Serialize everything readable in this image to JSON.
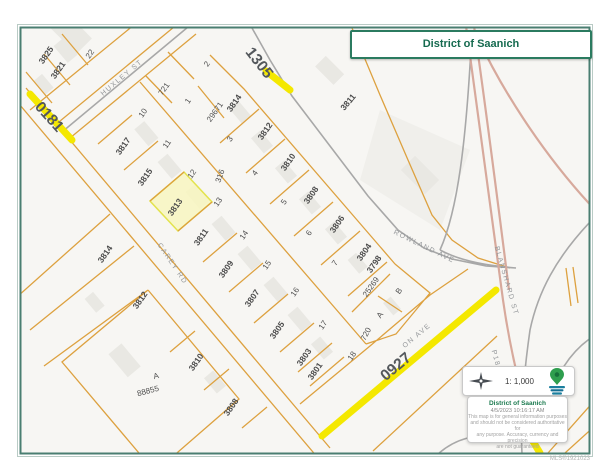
{
  "title_box": {
    "title": "District of Saanich"
  },
  "legend": {
    "scale": "1: 1,000",
    "org": "District of Saanich",
    "date": "4/5/2023 10:16:17 AM",
    "disclaimer_lines": [
      "This map is for general information purposes",
      "and should not be considered authoritative for",
      "any purpose. Accuracy, currency and precision",
      "are not guaranteed"
    ],
    "compass_icon": "north-arrow",
    "logo_icon": "saanich-map-pin"
  },
  "watermark": "MLS®1921023",
  "colors": {
    "frame": "#4a7e71",
    "title_green": "#156a4f",
    "parcel_line": "#dda13f",
    "highlight_route": "#f4e800",
    "selected_parcel_fill": "#f8f6c0",
    "selected_parcel_stroke": "#e3e34d",
    "highway_pink": "#d7a99c",
    "road_gray": "#a8a8a8",
    "logo_green": "#2f9e4e",
    "logo_teal": "#1b7f9e"
  },
  "map": {
    "selected_parcel": {
      "address": "3813",
      "lot": "12"
    },
    "labels": [
      {
        "name": "parcel-label-3825",
        "text": "3825",
        "x": 46,
        "y": 55,
        "r": -55,
        "cls": "addr"
      },
      {
        "name": "parcel-label-3821",
        "text": "3821",
        "x": 58,
        "y": 70,
        "r": -55,
        "cls": "addr"
      },
      {
        "name": "parcel-label-3817",
        "text": "3817",
        "x": 123,
        "y": 146,
        "r": -55,
        "cls": "addr"
      },
      {
        "name": "parcel-label-3815",
        "text": "3815",
        "x": 145,
        "y": 177,
        "r": -55,
        "cls": "addr"
      },
      {
        "name": "parcel-label-3813",
        "text": "3813",
        "x": 175,
        "y": 207,
        "r": -55,
        "cls": "addr"
      },
      {
        "name": "parcel-label-3811",
        "text": "3811",
        "x": 201,
        "y": 237,
        "r": -55,
        "cls": "addr"
      },
      {
        "name": "parcel-label-3809",
        "text": "3809",
        "x": 226,
        "y": 269,
        "r": -55,
        "cls": "addr"
      },
      {
        "name": "parcel-label-3807",
        "text": "3807",
        "x": 252,
        "y": 298,
        "r": -55,
        "cls": "addr"
      },
      {
        "name": "parcel-label-3805",
        "text": "3805",
        "x": 277,
        "y": 330,
        "r": -55,
        "cls": "addr"
      },
      {
        "name": "parcel-label-3803",
        "text": "3803",
        "x": 304,
        "y": 357,
        "r": -55,
        "cls": "addr"
      },
      {
        "name": "parcel-label-3801",
        "text": "3801",
        "x": 315,
        "y": 371,
        "r": -55,
        "cls": "addr"
      },
      {
        "name": "parcel-label-29671",
        "text": "29671",
        "x": 215,
        "y": 112,
        "r": -55,
        "cls": "lot"
      },
      {
        "name": "parcel-label-3814-upper",
        "text": "3814",
        "x": 234,
        "y": 103,
        "r": -55,
        "cls": "addr"
      },
      {
        "name": "parcel-label-3812-upper",
        "text": "3812",
        "x": 265,
        "y": 131,
        "r": -55,
        "cls": "addr"
      },
      {
        "name": "parcel-label-3810-upper",
        "text": "3810",
        "x": 288,
        "y": 162,
        "r": -55,
        "cls": "addr"
      },
      {
        "name": "parcel-label-3808-upper",
        "text": "3808",
        "x": 311,
        "y": 195,
        "r": -55,
        "cls": "addr"
      },
      {
        "name": "parcel-label-3806",
        "text": "3806",
        "x": 337,
        "y": 224,
        "r": -55,
        "cls": "addr"
      },
      {
        "name": "parcel-label-3804",
        "text": "3804",
        "x": 364,
        "y": 252,
        "r": -55,
        "cls": "addr"
      },
      {
        "name": "parcel-label-3798",
        "text": "3798",
        "x": 374,
        "y": 264,
        "r": -55,
        "cls": "addr"
      },
      {
        "name": "parcel-label-25269",
        "text": "25269",
        "x": 371,
        "y": 287,
        "r": -55,
        "cls": "lot"
      },
      {
        "name": "parcel-label-720",
        "text": "720",
        "x": 366,
        "y": 334,
        "r": -62,
        "cls": "lot"
      },
      {
        "name": "parcel-label-3814-sw",
        "text": "3814",
        "x": 105,
        "y": 254,
        "r": -55,
        "cls": "addr"
      },
      {
        "name": "parcel-label-3812-sw",
        "text": "3812",
        "x": 140,
        "y": 300,
        "r": -55,
        "cls": "addr"
      },
      {
        "name": "parcel-label-3810-sw",
        "text": "3810",
        "x": 196,
        "y": 362,
        "r": -55,
        "cls": "addr"
      },
      {
        "name": "parcel-label-3808-sw",
        "text": "3808",
        "x": 231,
        "y": 407,
        "r": -55,
        "cls": "addr"
      },
      {
        "name": "parcel-label-3811-east",
        "text": "3811",
        "x": 348,
        "y": 102,
        "r": -50,
        "cls": "addr"
      },
      {
        "name": "plan-label-88855",
        "text": "88855",
        "x": 148,
        "y": 391,
        "r": -15,
        "cls": "lot"
      },
      {
        "name": "lot-label-a-sw",
        "text": "A",
        "x": 156,
        "y": 376,
        "r": -15,
        "cls": "lot"
      },
      {
        "name": "lot-label-22",
        "text": "22",
        "x": 90,
        "y": 54,
        "r": -55,
        "cls": "lot"
      },
      {
        "name": "lot-label-721",
        "text": "721",
        "x": 164,
        "y": 89,
        "r": -55,
        "cls": "lot"
      },
      {
        "name": "lot-label-10",
        "text": "10",
        "x": 143,
        "y": 113,
        "r": -55,
        "cls": "lot"
      },
      {
        "name": "lot-label-11",
        "text": "11",
        "x": 167,
        "y": 144,
        "r": -55,
        "cls": "lot"
      },
      {
        "name": "lot-label-12",
        "text": "12",
        "x": 192,
        "y": 174,
        "r": -55,
        "cls": "lot"
      },
      {
        "name": "lot-label-13",
        "text": "13",
        "x": 218,
        "y": 202,
        "r": -55,
        "cls": "lot"
      },
      {
        "name": "lot-label-14",
        "text": "14",
        "x": 244,
        "y": 235,
        "r": -55,
        "cls": "lot"
      },
      {
        "name": "lot-label-15",
        "text": "15",
        "x": 267,
        "y": 265,
        "r": -55,
        "cls": "lot"
      },
      {
        "name": "lot-label-16",
        "text": "16",
        "x": 295,
        "y": 292,
        "r": -55,
        "cls": "lot"
      },
      {
        "name": "lot-label-17",
        "text": "17",
        "x": 323,
        "y": 325,
        "r": -55,
        "cls": "lot"
      },
      {
        "name": "lot-label-18",
        "text": "18",
        "x": 352,
        "y": 356,
        "r": -55,
        "cls": "lot"
      },
      {
        "name": "lot-label-1",
        "text": "1",
        "x": 188,
        "y": 101,
        "r": -55,
        "cls": "lot"
      },
      {
        "name": "lot-label-2",
        "text": "2",
        "x": 207,
        "y": 64,
        "r": -55,
        "cls": "lot"
      },
      {
        "name": "lot-label-3",
        "text": "3",
        "x": 230,
        "y": 139,
        "r": -55,
        "cls": "lot"
      },
      {
        "name": "lot-label-4",
        "text": "4",
        "x": 255,
        "y": 173,
        "r": -55,
        "cls": "lot"
      },
      {
        "name": "lot-label-5",
        "text": "5",
        "x": 284,
        "y": 202,
        "r": -55,
        "cls": "lot"
      },
      {
        "name": "lot-label-6",
        "text": "6",
        "x": 309,
        "y": 233,
        "r": -55,
        "cls": "lot"
      },
      {
        "name": "lot-label-7",
        "text": "7",
        "x": 335,
        "y": 263,
        "r": -55,
        "cls": "lot"
      },
      {
        "name": "lot-label-b",
        "text": "B",
        "x": 399,
        "y": 291,
        "r": -55,
        "cls": "lot"
      },
      {
        "name": "lot-label-a",
        "text": "A",
        "x": 380,
        "y": 315,
        "r": -55,
        "cls": "lot"
      },
      {
        "name": "plan-label-316",
        "text": "316",
        "x": 220,
        "y": 176,
        "r": -70,
        "cls": "lot"
      },
      {
        "name": "street-label-huxley-st",
        "text": "HUXLEY ST",
        "x": 122,
        "y": 78,
        "r": -40,
        "cls": "street"
      },
      {
        "name": "street-label-carey-rd",
        "text": "CAREY RD",
        "x": 172,
        "y": 264,
        "r": 56,
        "cls": "street"
      },
      {
        "name": "street-label-rowland-ave",
        "text": "ROWLAND AVE",
        "x": 424,
        "y": 247,
        "r": 26,
        "cls": "street"
      },
      {
        "name": "street-label-blanshard-st",
        "text": "BLANSHARD ST",
        "x": 506,
        "y": 281,
        "r": 74,
        "cls": "street"
      },
      {
        "name": "street-label-vernon-ave",
        "text": "ON AVE",
        "x": 417,
        "y": 336,
        "r": -40,
        "cls": "street"
      },
      {
        "name": "street-label-p185",
        "text": "P185",
        "x": 496,
        "y": 361,
        "r": 75,
        "cls": "street"
      },
      {
        "name": "route-label-0181",
        "text": "0181",
        "x": 49,
        "y": 117,
        "r": 48,
        "cls": "route"
      },
      {
        "name": "route-label-1305",
        "text": "1305",
        "x": 259,
        "y": 63,
        "r": 52,
        "cls": "route"
      },
      {
        "name": "route-label-0927",
        "text": "0927",
        "x": 396,
        "y": 367,
        "r": -40,
        "cls": "route"
      }
    ]
  }
}
